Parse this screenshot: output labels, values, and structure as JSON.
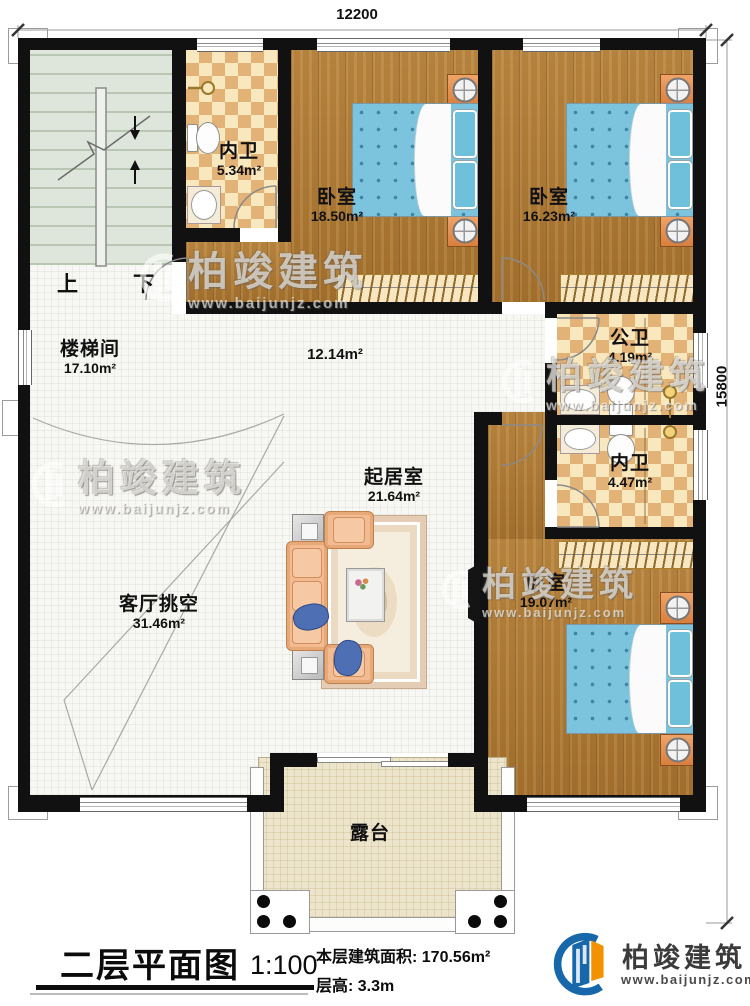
{
  "plan": {
    "dim_top": "12200",
    "dim_right": "15800",
    "stairs": {
      "up": "上",
      "down": "下"
    },
    "rooms": {
      "bath_top": {
        "name": "内卫",
        "area": "5.34m²"
      },
      "bedroom1": {
        "name": "卧室",
        "area": "18.50m²"
      },
      "bedroom2": {
        "name": "卧室",
        "area": "16.23m²"
      },
      "stairwell": {
        "name": "楼梯间",
        "area": "17.10m²"
      },
      "hall": {
        "area": "12.14m²"
      },
      "bath_public": {
        "name": "公卫",
        "area": "4.19m²"
      },
      "bath_inner": {
        "name": "内卫",
        "area": "4.47m²"
      },
      "living": {
        "name": "起居室",
        "area": "21.64m²"
      },
      "void": {
        "name": "客厅挑空",
        "area": "31.46m²"
      },
      "bedroom3": {
        "name": "卧室",
        "area": "19.07m²"
      },
      "terrace": {
        "name": "露台"
      }
    }
  },
  "titleblock": {
    "title": "二层平面图",
    "scale": "1:100",
    "floor_area": "本层建筑面积: 170.56m²",
    "floor_height": "层高: 3.3m"
  },
  "brand": {
    "name": "柏竣建筑",
    "website": "www.baijunjz.com"
  },
  "watermark": {
    "name": "柏竣建筑",
    "website": "www.baijunjz.com"
  },
  "colors": {
    "wall": "#111111",
    "wood_floor": "#ad7835",
    "tile_light": "#f9e7bd",
    "tile_dark": "#e3b277",
    "bed_blue": "#7cc4dd",
    "stair_floor": "#dee5da",
    "terrace_floor": "#ede5cb",
    "brand_blue": "#1767ab",
    "brand_orange": "#f29200"
  }
}
